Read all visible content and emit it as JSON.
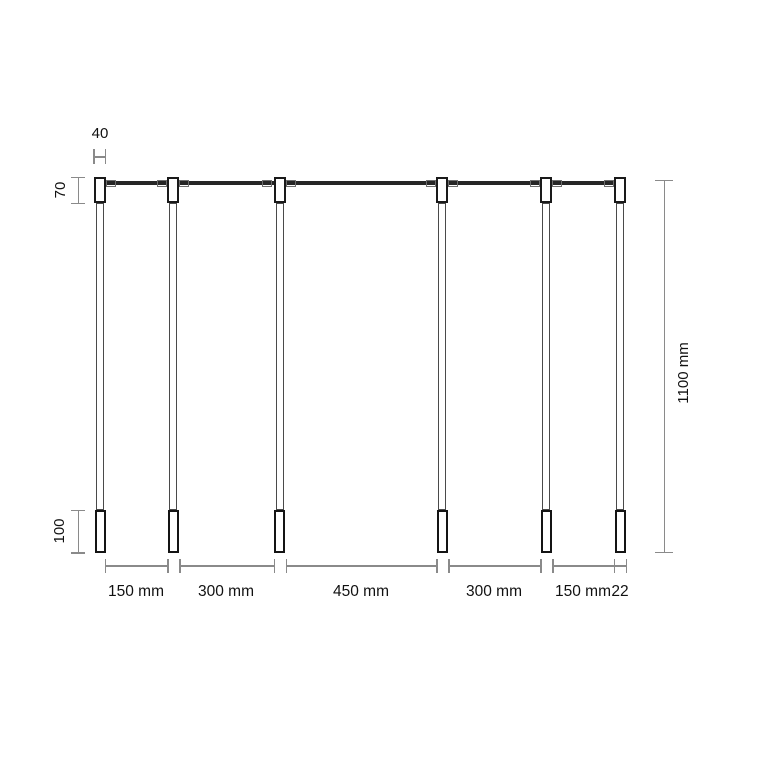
{
  "drawing": {
    "object": "post-and-rail-elevation",
    "units": "mm",
    "post_count": 6,
    "dims": {
      "post_top_width": "40",
      "top_section_height": "70",
      "bottom_section_height": "100",
      "overall_height": "1100 mm",
      "spacings": [
        "150 mm",
        "300 mm",
        "450 mm",
        "300 mm",
        "150 mm"
      ],
      "post_width": "22"
    },
    "colors": {
      "outline_dark": "#1a1a1a",
      "outline_medium": "#4a4a4a",
      "rail": "#262626",
      "connector": "#6e6e6e",
      "dimension_line": "#8a8a8a",
      "text": "#111111",
      "background": "#ffffff"
    }
  }
}
